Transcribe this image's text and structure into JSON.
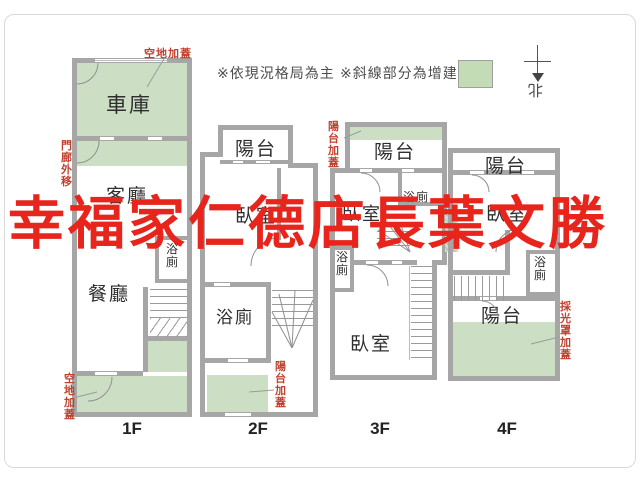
{
  "legend": {
    "note1": "※依現況格局為主",
    "note2": "※斜線部分為增建"
  },
  "compass": {
    "north": "北"
  },
  "watermark": {
    "text": "幸福家仁德店長葉文勝"
  },
  "colors": {
    "addition_green": "#ccdfc4",
    "wall_gray": "#a6a6a6",
    "annotation_red": "#c0402f",
    "watermark_red": "#e8251c"
  },
  "floors": {
    "f1": {
      "label": "1F",
      "garage": "車庫",
      "living": "客廳",
      "dining": "餐廳",
      "bath": "浴廁",
      "ann_top": "空地加蓋",
      "ann_left": "門廊外移",
      "ann_bottom": "空地加蓋"
    },
    "f2": {
      "label": "2F",
      "balcony": "陽台",
      "bedroom": "臥室",
      "bath": "浴廁",
      "ann_right": "陽台加蓋"
    },
    "f3": {
      "label": "3F",
      "balcony": "陽台",
      "bedroom_upper": "臥室",
      "bath_upper": "浴廁",
      "bath_lower": "浴廁",
      "bedroom_lower": "臥室",
      "ann_left": "陽台加蓋"
    },
    "f4": {
      "label": "4F",
      "balcony_top": "陽台",
      "bedroom": "臥室",
      "bath": "浴廁",
      "balcony_bottom": "陽台",
      "ann_right": "採光罩加蓋"
    }
  }
}
